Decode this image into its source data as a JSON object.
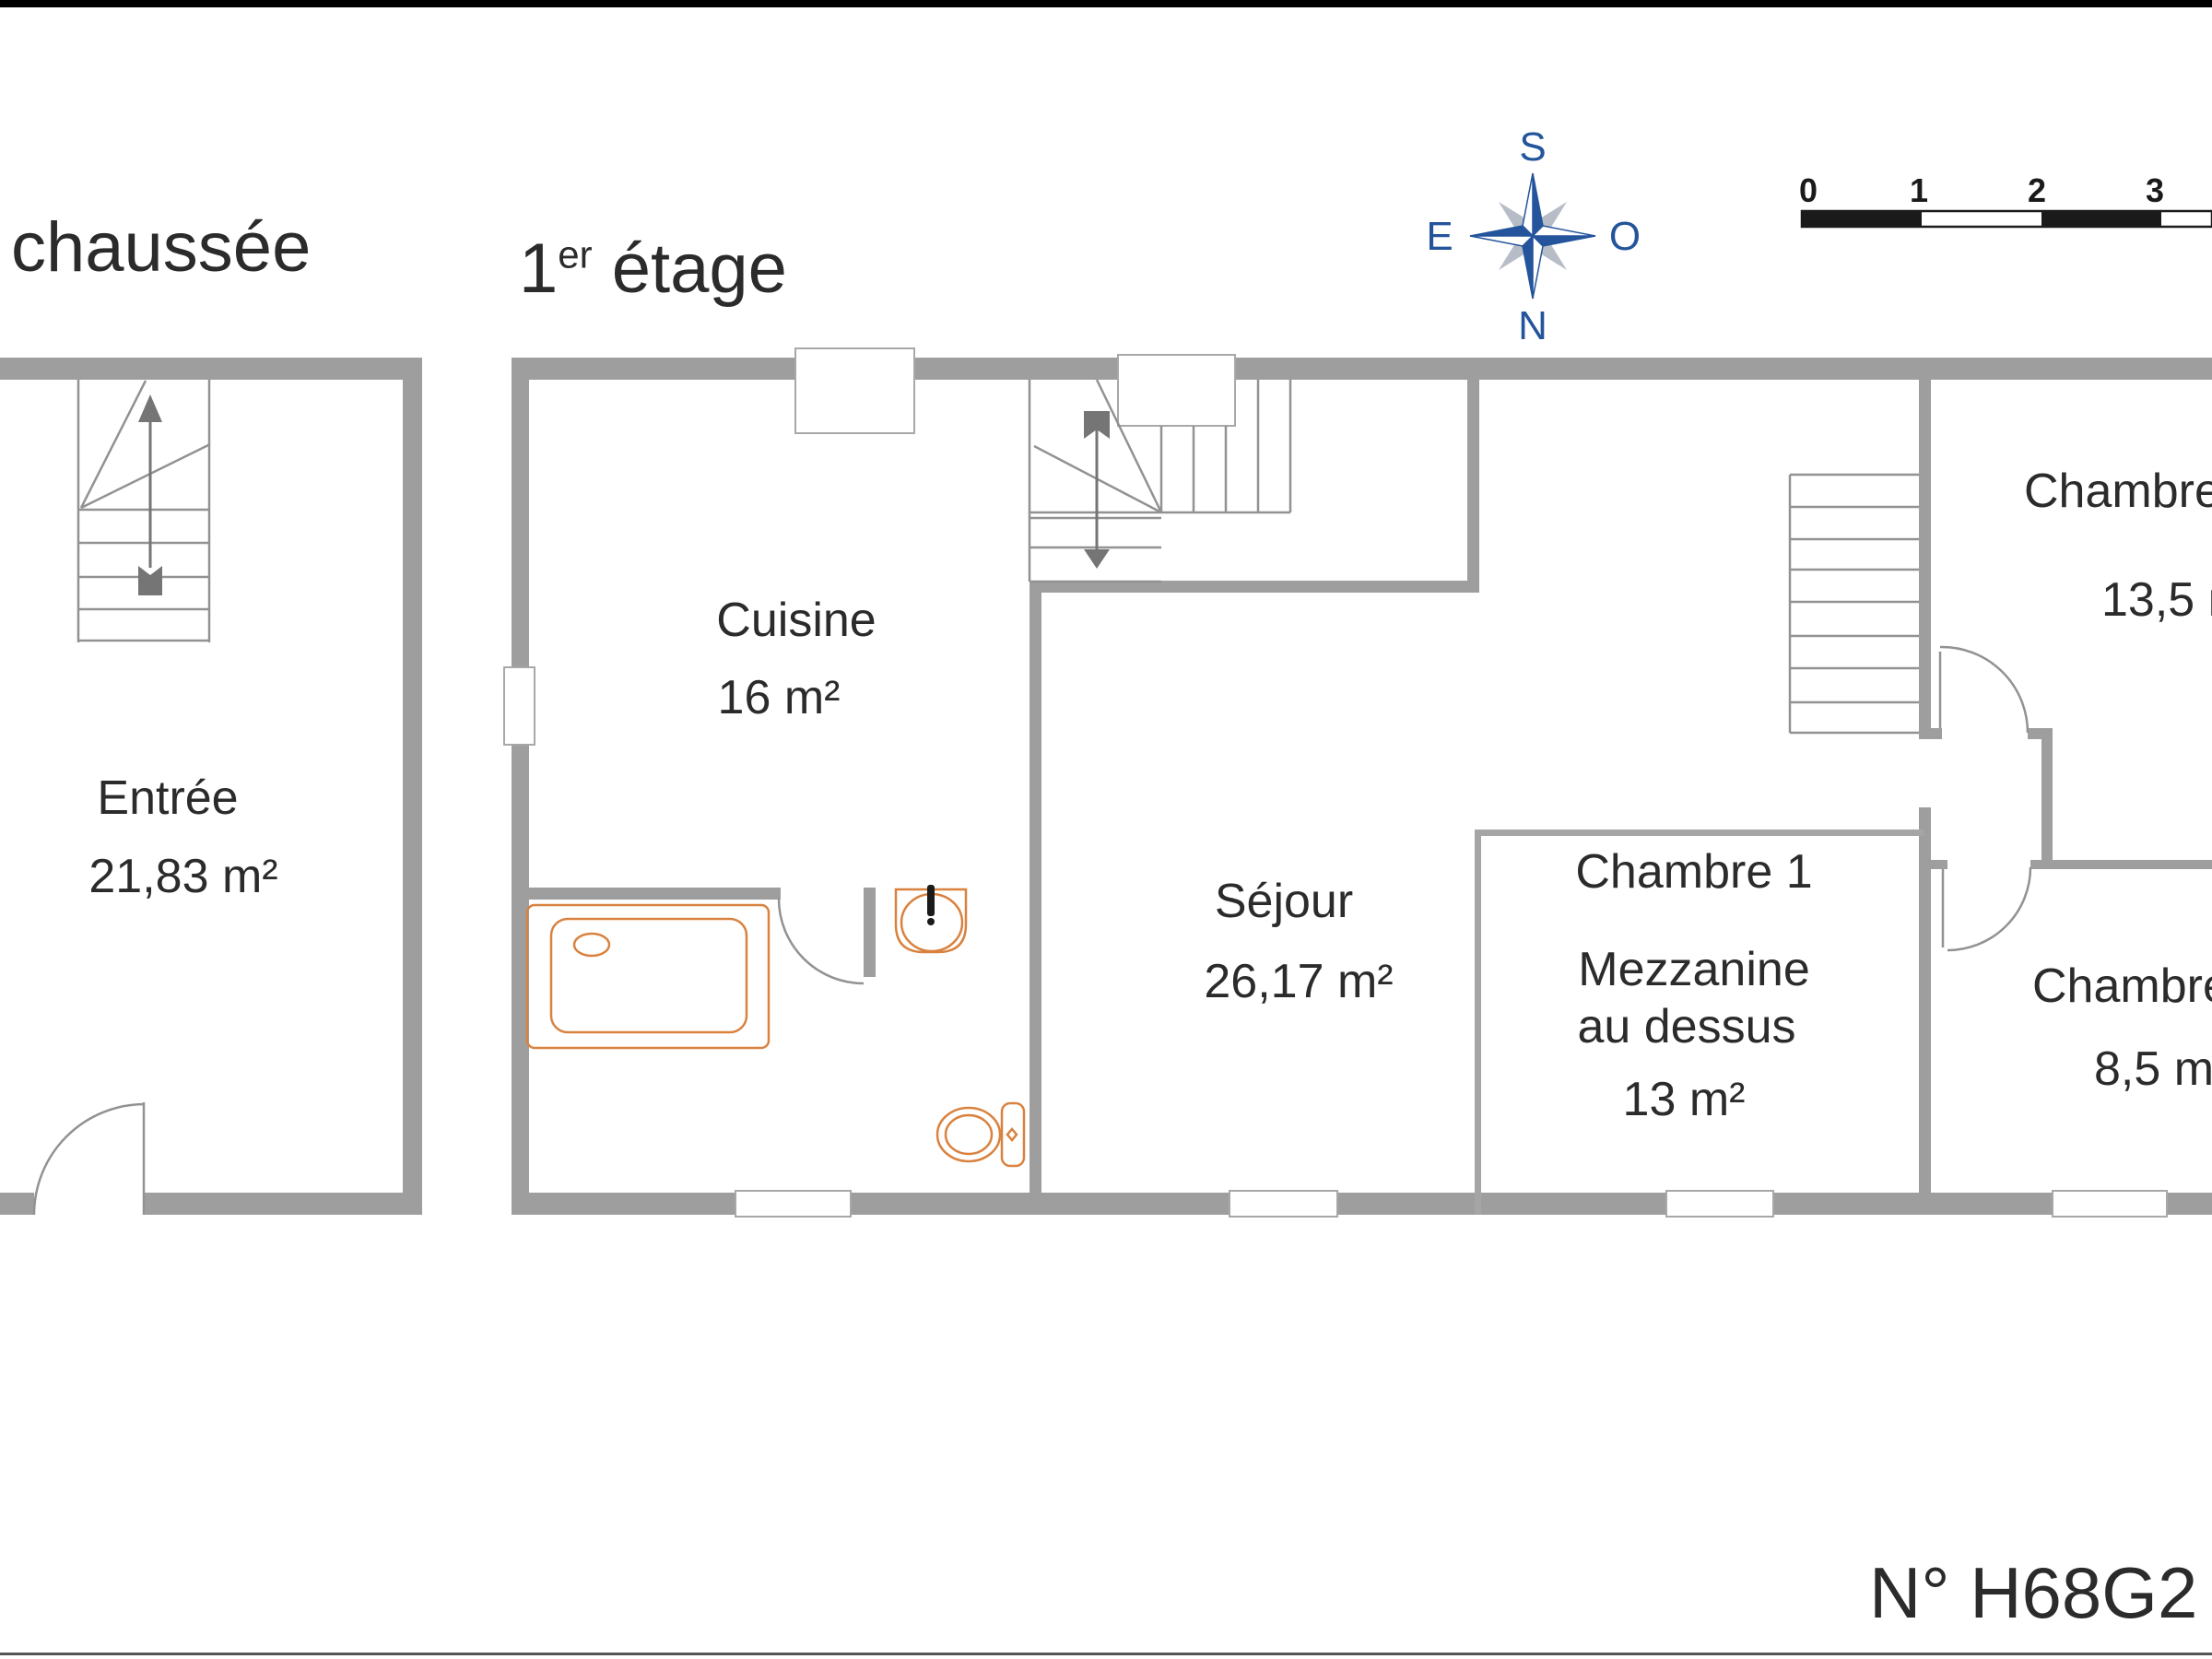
{
  "titles": {
    "ground_floor": "chaussée",
    "first_floor": {
      "num": "1",
      "sup": "er",
      "rest": " étage"
    }
  },
  "compass": {
    "top": "S",
    "bottom": "N",
    "left": "E",
    "right": "O"
  },
  "scale_bar": {
    "ticks": [
      "0",
      "1",
      "2",
      "3"
    ]
  },
  "rooms": {
    "entree": {
      "name": "Entrée",
      "area": "21,83 m²"
    },
    "cuisine": {
      "name": "Cuisine",
      "area": "16 m²"
    },
    "sejour": {
      "name": "Séjour",
      "area": "26,17 m²"
    },
    "chambre1": {
      "name": "Chambre 1",
      "note1": "Mezzanine",
      "note2": "au dessus",
      "area": "13 m²"
    },
    "chambre_top_right": {
      "name": "Chambre",
      "area": "13,5 m²"
    },
    "chambre_bottom_right": {
      "name": "Chambre",
      "area": "8,5 m²"
    }
  },
  "reference": {
    "label": "N° H68G2"
  },
  "colors": {
    "wall": "#9e9e9e",
    "fixture": "#d9823f",
    "compass_blue": "#24549c"
  }
}
